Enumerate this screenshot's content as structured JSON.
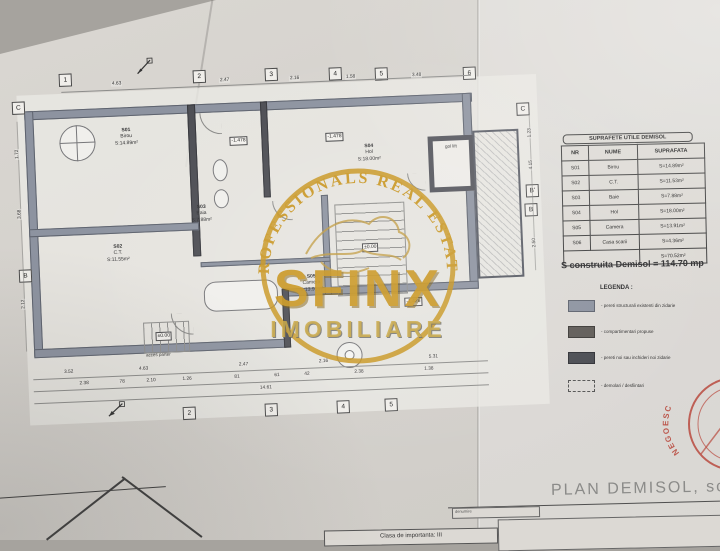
{
  "watermark": {
    "arc_text": "PROFESSIONALS REAL ESTATE",
    "brand": "SFINX",
    "sub_brand": "IMOBILIARE"
  },
  "areas_table": {
    "title": "SUPRAFETE UTILE DEMISOL",
    "headers": [
      "NR",
      "NUME",
      "SUPRAFATA"
    ],
    "rows": [
      {
        "nr": "S01",
        "nume": "Birou",
        "suprafata": "S=14.89m²"
      },
      {
        "nr": "S02",
        "nume": "C.T.",
        "suprafata": "S=11.53m²"
      },
      {
        "nr": "S03",
        "nume": "Baie",
        "suprafata": "S=7.88m²"
      },
      {
        "nr": "S04",
        "nume": "Hol",
        "suprafata": "S=18.00m²"
      },
      {
        "nr": "S05",
        "nume": "Camera",
        "suprafata": "S=13.91m²"
      },
      {
        "nr": "S06",
        "nume": "Casa scarii",
        "suprafata": "S=4.36m²"
      }
    ],
    "total": "S=70.52m²"
  },
  "built_area": "S construita Demisol = 114.70 mp",
  "legend": {
    "title": "LEGENDA :",
    "items": [
      {
        "label": "- pereti structurali existenti din zidarie"
      },
      {
        "label": "- compartimentari propuse"
      },
      {
        "label": "- pereti noi sau inchideri noi zidarie"
      },
      {
        "label": "- demolari / desfiintari"
      }
    ]
  },
  "plan": {
    "grid_top": [
      "1",
      "2",
      "3",
      "4",
      "5",
      "6"
    ],
    "grid_bottom": [
      "2",
      "3",
      "4",
      "5"
    ],
    "grid_left": [
      "C",
      "B"
    ],
    "grid_right": [
      "C",
      "B'",
      "B"
    ],
    "rooms": [
      {
        "id": "S01",
        "name": "Birou",
        "area": "S:14.89m²"
      },
      {
        "id": "S02",
        "name": "C.T.",
        "area": "S:11.55m²"
      },
      {
        "id": "S03",
        "name": "Baia",
        "area": "S:7.88m²"
      },
      {
        "id": "S04",
        "name": "Hol",
        "area": "S:18.00m²"
      },
      {
        "id": "S05",
        "name": "Camera",
        "area": "S:13.91m²"
      }
    ],
    "levels": [
      "-1.478",
      "-1.478",
      "±0.00",
      "±0.00",
      "-1.426"
    ],
    "notes": {
      "access": "acces parter",
      "lift": "gol lift"
    },
    "dims_top": [
      "4.63",
      "2.47",
      "2.16",
      "1.58",
      "3.48"
    ],
    "dims_bottom1": [
      "3.52",
      "4.63",
      "2.47",
      "2.16",
      "5.31"
    ],
    "dims_bottom2": [
      "2.38",
      "78",
      "2.10",
      "1.26",
      "81",
      "61",
      "42",
      "2.38",
      "1.38"
    ],
    "dims_bottom_total": "14.61",
    "dims_left": [
      "1.72",
      "3.68",
      "2.12"
    ],
    "dims_right": [
      "1.23",
      "4.15",
      "2.50"
    ]
  },
  "titleblock": {
    "plan_title": "PLAN DEMISOL, sc",
    "denumire": "denumire",
    "clasa": "Clasa de importanta: III"
  },
  "stamp": {
    "text": "NEGOESC"
  }
}
